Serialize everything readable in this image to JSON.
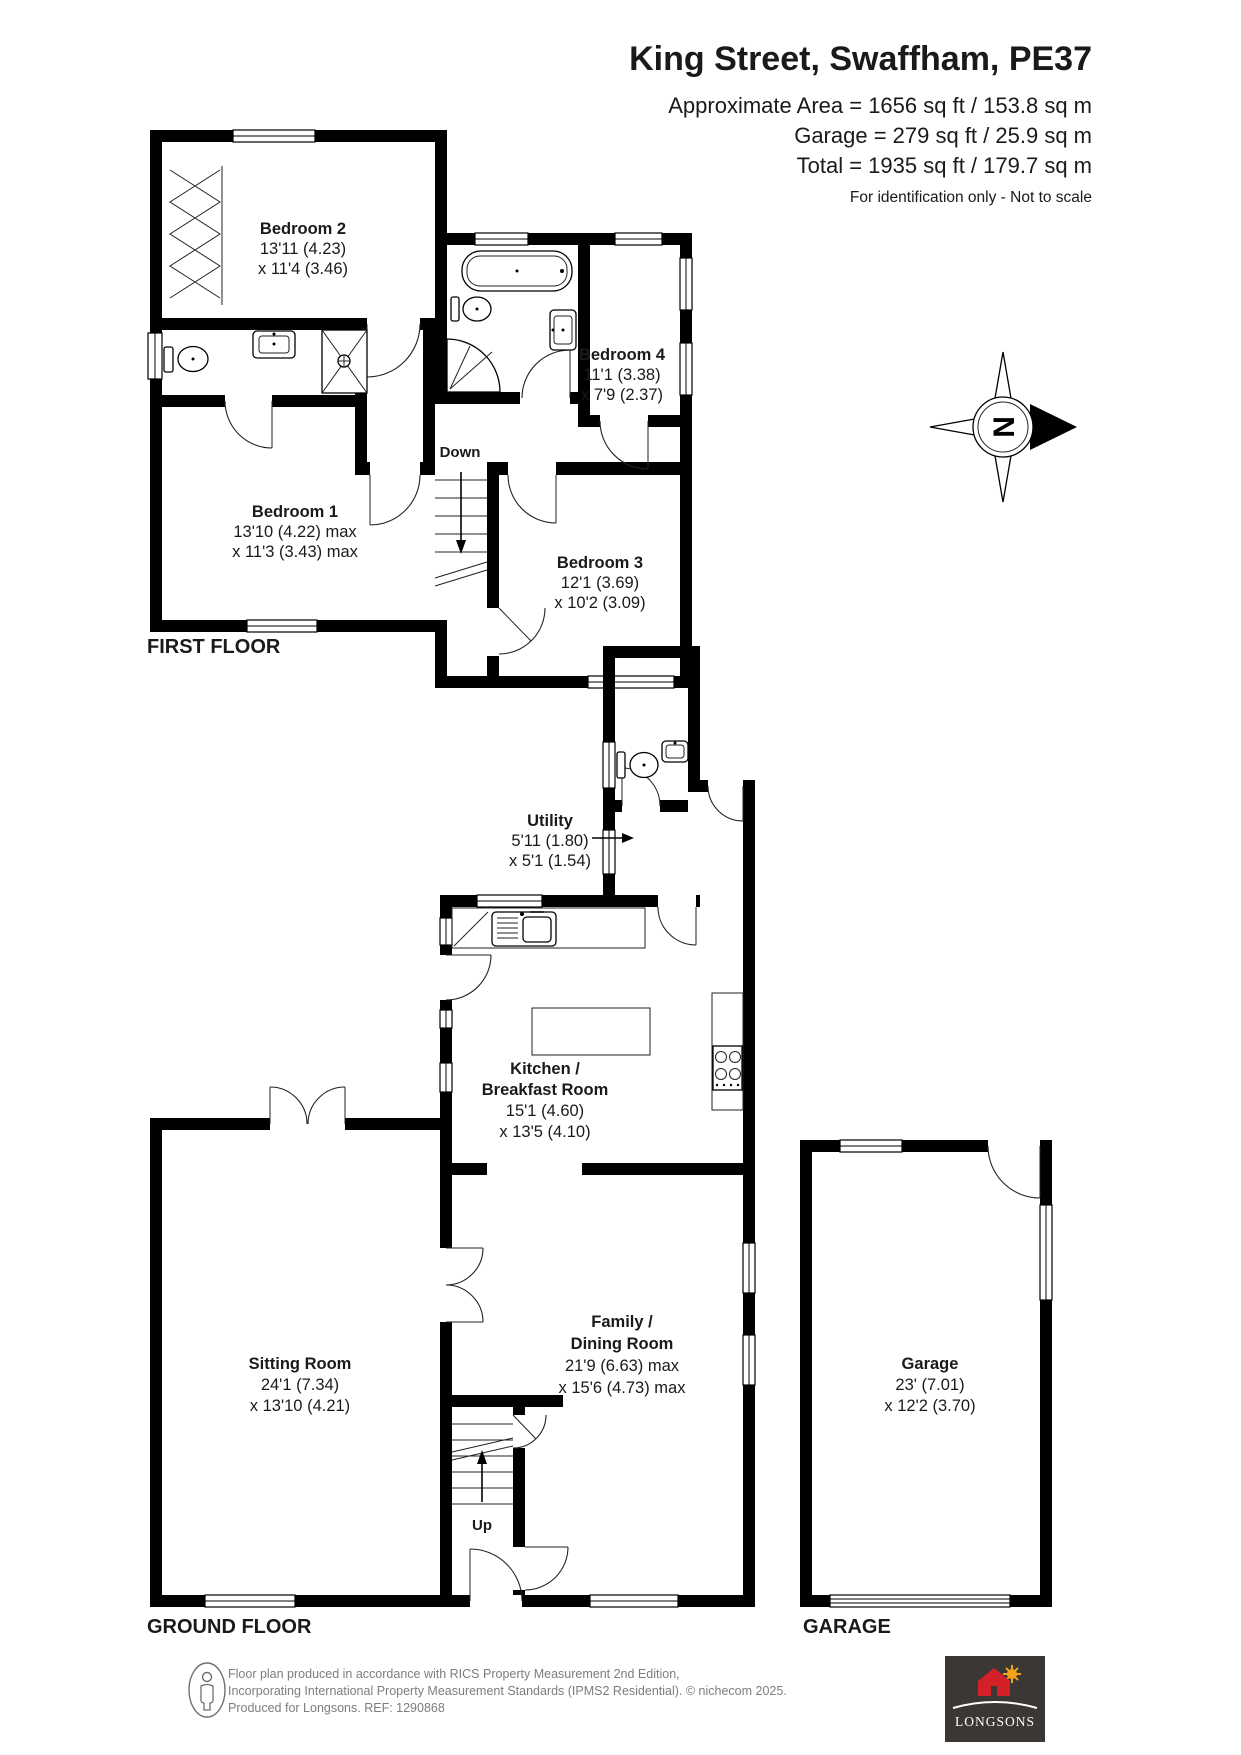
{
  "header": {
    "title": "King Street, Swaffham, PE37",
    "area_lines": [
      "Approximate Area = 1656 sq ft / 153.8 sq m",
      "Garage = 279 sq ft / 25.9 sq m",
      "Total = 1935 sq ft / 179.7 sq m"
    ],
    "note": "For identification only - Not to scale"
  },
  "compass": {
    "letter": "N"
  },
  "floors": {
    "first": {
      "label": "FIRST FLOOR",
      "stairs_label": "Down",
      "rooms": {
        "bedroom2": {
          "name": "Bedroom 2",
          "dim1": "13'11 (4.23)",
          "dim2": "x 11'4 (3.46)"
        },
        "bedroom4": {
          "name": "Bedroom 4",
          "dim1": "11'1 (3.38)",
          "dim2": "x 7'9 (2.37)"
        },
        "bedroom1": {
          "name": "Bedroom 1",
          "dim1": "13'10 (4.22) max",
          "dim2": "x 11'3 (3.43) max"
        },
        "bedroom3": {
          "name": "Bedroom 3",
          "dim1": "12'1 (3.69)",
          "dim2": "x 10'2 (3.09)"
        }
      }
    },
    "ground": {
      "label": "GROUND FLOOR",
      "stairs_label": "Up",
      "rooms": {
        "utility": {
          "name": "Utility",
          "dim1": "5'11 (1.80)",
          "dim2": "x 5'1 (1.54)"
        },
        "kitchen": {
          "name": "Kitchen /",
          "name2": "Breakfast Room",
          "dim1": "15'1 (4.60)",
          "dim2": "x 13'5 (4.10)"
        },
        "sitting": {
          "name": "Sitting Room",
          "dim1": "24'1 (7.34)",
          "dim2": "x 13'10 (4.21)"
        },
        "family": {
          "name": "Family /",
          "name2": "Dining Room",
          "dim1": "21'9 (6.63) max",
          "dim2": "x 15'6 (4.73) max"
        }
      }
    },
    "garage": {
      "label": "GARAGE",
      "rooms": {
        "garage": {
          "name": "Garage",
          "dim1": "23' (7.01)",
          "dim2": "x 12'2 (3.70)"
        }
      }
    }
  },
  "footer": {
    "line1": "Floor plan produced in accordance with RICS Property Measurement 2nd Edition,",
    "line2": "Incorporating International Property Measurement Standards (IPMS2 Residential).   © nichecom 2025.",
    "line3": "Produced for Longsons.   REF:    1290868",
    "logo_text": "LONGSONS"
  },
  "colors": {
    "walls": "#000000",
    "logo_background": "#3b3734",
    "logo_house_red": "#d42027",
    "logo_sun_gold": "#f0a31c",
    "footer_text": "#7d7d7d"
  }
}
